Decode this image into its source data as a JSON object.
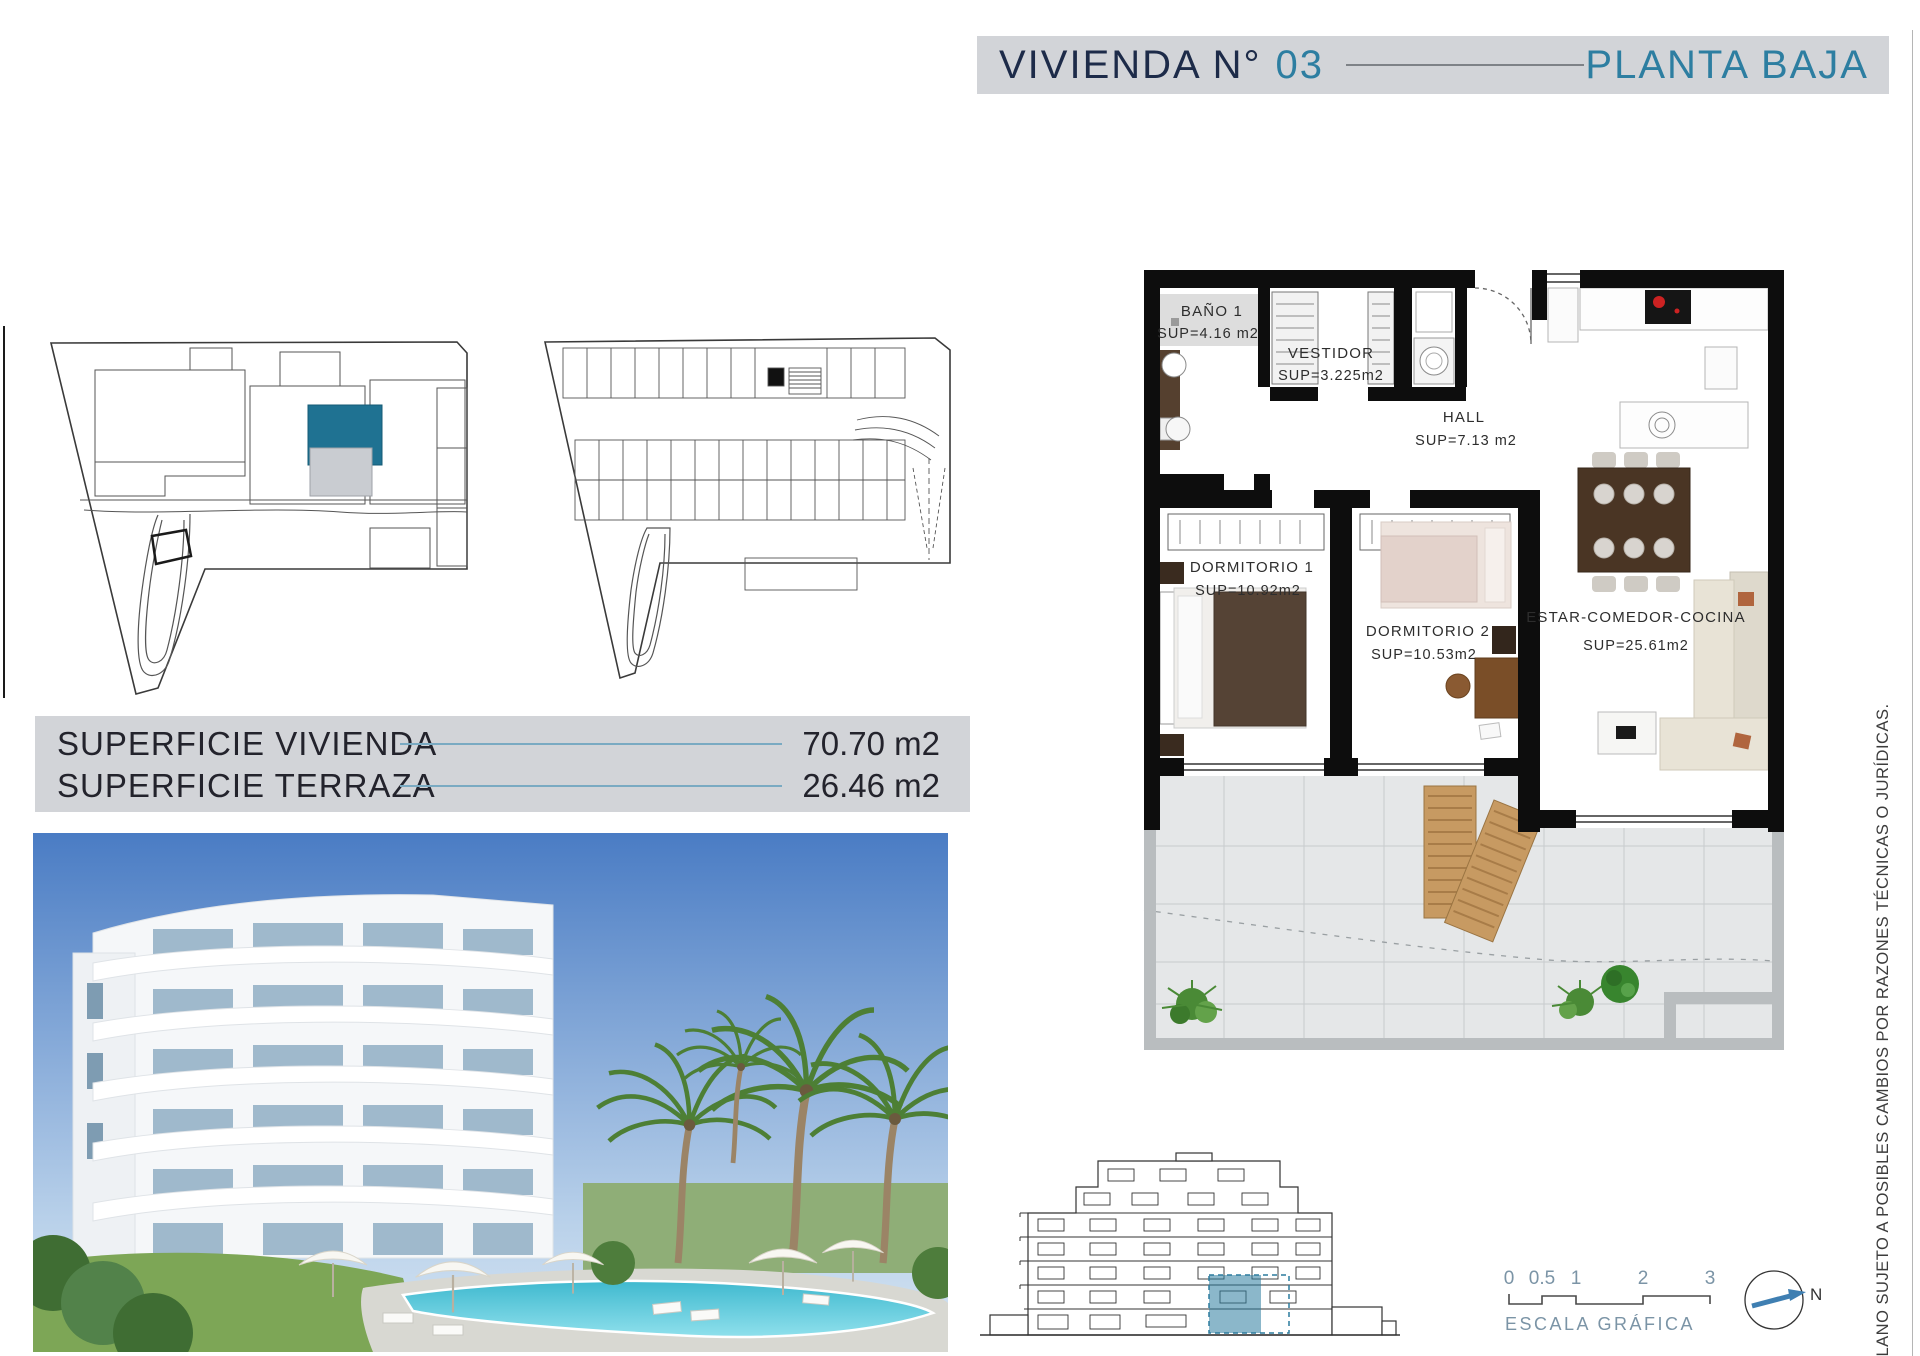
{
  "header": {
    "title_prefix": "VIVIENDA N°",
    "unit_number": "03",
    "floor_label": "PLANTA BAJA"
  },
  "areas": {
    "rows": [
      {
        "label": "SUPERFICIE VIVIENDA",
        "value": "70.70 m2"
      },
      {
        "label": "SUPERFICIE TERRAZA",
        "value": "26.46 m2"
      }
    ]
  },
  "floor_plan": {
    "rooms": [
      {
        "name": "BAÑO 1",
        "sup": "SUP=4.16 m2"
      },
      {
        "name": "VESTIDOR",
        "sup": "SUP=3.225m2"
      },
      {
        "name": "HALL",
        "sup": "SUP=7.13 m2"
      },
      {
        "name": "DORMITORIO 1",
        "sup": "SUP=10.92m2"
      },
      {
        "name": "DORMITORIO 2",
        "sup": "SUP=10.53m2"
      },
      {
        "name": "ESTAR-COMEDOR-COCINA",
        "sup": "SUP=25.61m2"
      }
    ]
  },
  "scale_bar": {
    "ticks": [
      "0",
      "0.5",
      "1",
      "2",
      "3"
    ],
    "label": "ESCALA GRÁFICA"
  },
  "compass": {
    "north": "N"
  },
  "disclaimer": "PLANO SUJETO A POSIBLES CAMBIOS POR RAZONES TÉCNICAS O JURÍDICAS.",
  "colors": {
    "header_bar_gray": "#d2d4d8",
    "header_navy": "#1d2b49",
    "accent_teal": "#2d7ea1",
    "unit_highlight_fill": "#1f7292",
    "area_line_teal": "#7aaac2",
    "scale_text_blue": "#7b94a6",
    "wall_black": "#0d0d0d"
  }
}
